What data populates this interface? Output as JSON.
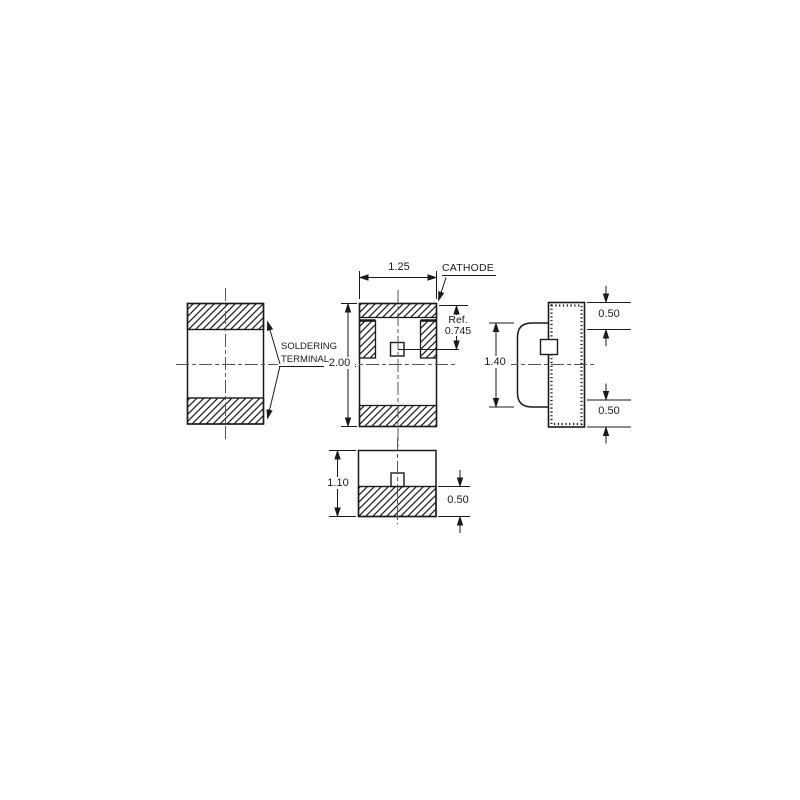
{
  "title": "Chip LED package outline drawing",
  "labels": {
    "cathode": "CATHODE",
    "soldering_terminal_line1": "SOLDERING",
    "soldering_terminal_line2": "TERMINAL"
  },
  "dimensions": {
    "front_width": "1.25",
    "front_height": "2.00",
    "ref_label": "Ref.",
    "ref_value": "0.745",
    "side_body_height": "1.40",
    "side_terminal_top": "0.50",
    "side_terminal_bottom": "0.50",
    "bottom_view_height": "1.10",
    "bottom_view_terminal": "0.50"
  },
  "colors": {
    "line": "#1a1a1a",
    "centerline": "#555555",
    "background": "#ffffff"
  }
}
